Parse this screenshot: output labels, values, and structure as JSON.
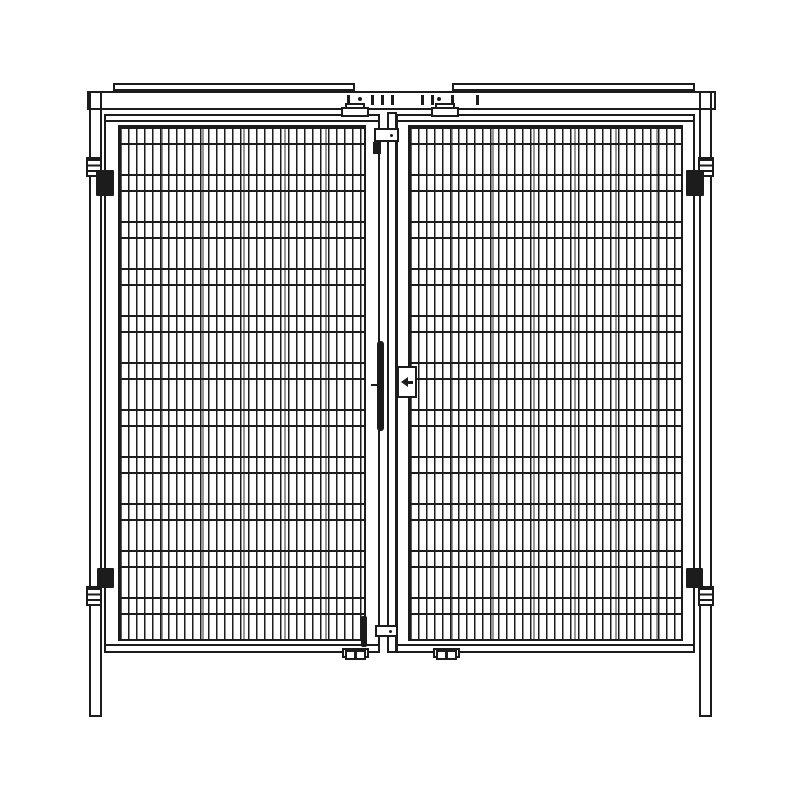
{
  "meta": {
    "description": "Monochrome CAD-style front elevation drawing of a double-leaf wire mesh gate (machine guarding double door) with posts, header rail, hinges and center lock",
    "view": "front elevation"
  },
  "colors": {
    "background": "#ffffff",
    "line": "#1c1c1c",
    "fill": "#ffffff"
  },
  "drawing": {
    "counts": {
      "door_leaves": 2,
      "hinges": 4,
      "top_brackets": 2,
      "bottom_brackets": 2,
      "cover_plates": 2,
      "posts": 2
    },
    "lock_arrow_direction": "left",
    "parts": {
      "canvas": "Mesh double door technical drawing",
      "cover_plate_left": "Top cover plate (left)",
      "cover_plate_right": "Top cover plate (right)",
      "header_rail": "Header rail",
      "header_fasteners": "Header fasteners",
      "post_left": "Left post with floor leg",
      "post_right": "Right post with floor leg",
      "door_left": "Left mesh door leaf",
      "door_right": "Right mesh door leaf",
      "mesh_left": "Left door wire mesh panel",
      "mesh_right": "Right door wire mesh panel",
      "bracket_top_left": "Top guide bracket (left leaf)",
      "bracket_top_right": "Top guide bracket (right leaf)",
      "foot_bottom_left": "Bottom stop bracket (left leaf)",
      "foot_bottom_right": "Bottom stop bracket (right leaf)",
      "astragal": "Center meeting stile",
      "latch_top": "Top latch keeper",
      "latch_bottom": "Bottom latch keeper",
      "bolt_top": "Top drop bolt",
      "bolt_bottom": "Bottom drop bolt",
      "handle": "Center pull handle",
      "lock_plate": "Lock plate",
      "lock_arrow": "Lock direction arrow pointing left",
      "hinge_top_left": "Top hinge (left)",
      "hinge_bottom_left": "Bottom hinge (left)",
      "hinge_top_right": "Top hinge (right)",
      "hinge_bottom_right": "Bottom hinge (right)"
    }
  }
}
